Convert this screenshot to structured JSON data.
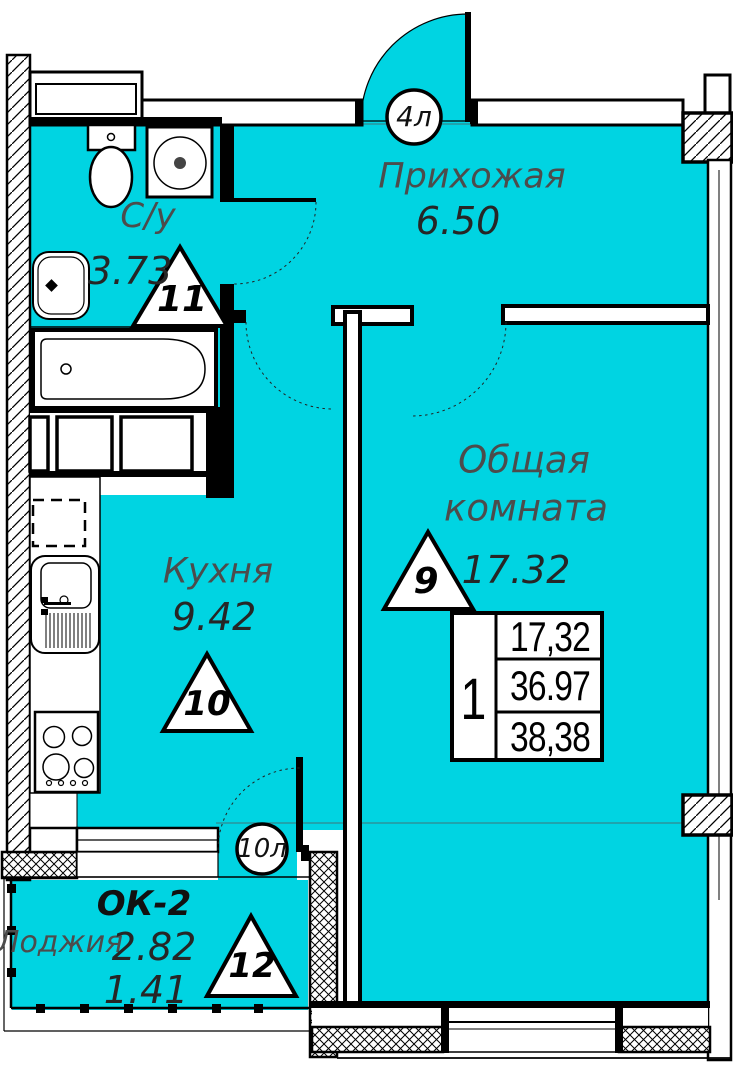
{
  "rooms": {
    "bathroom": {
      "name": "С/у",
      "area": "3.73"
    },
    "hallway": {
      "name": "Прихожая",
      "area": "6.50"
    },
    "kitchen": {
      "name": "Кухня",
      "area": "9.42"
    },
    "living": {
      "name_line1": "Общая",
      "name_line2": "комната",
      "area": "17.32"
    },
    "loggia": {
      "name": "Лоджия",
      "area_full": "2.82",
      "area_reduced": "1.41",
      "window_mark": "ОК-2"
    }
  },
  "markers": {
    "bathroom": "11",
    "living": "9",
    "kitchen": "10",
    "loggia": "12"
  },
  "doors": {
    "entrance": "4л",
    "loggia_door": "10л"
  },
  "table": {
    "number": "1",
    "rows": [
      "17,32",
      "36.97",
      "38,38"
    ]
  },
  "colors": {
    "floor_fill": "#00d4e2",
    "wall": "#000000",
    "muted_text": "#4c4c4c"
  }
}
